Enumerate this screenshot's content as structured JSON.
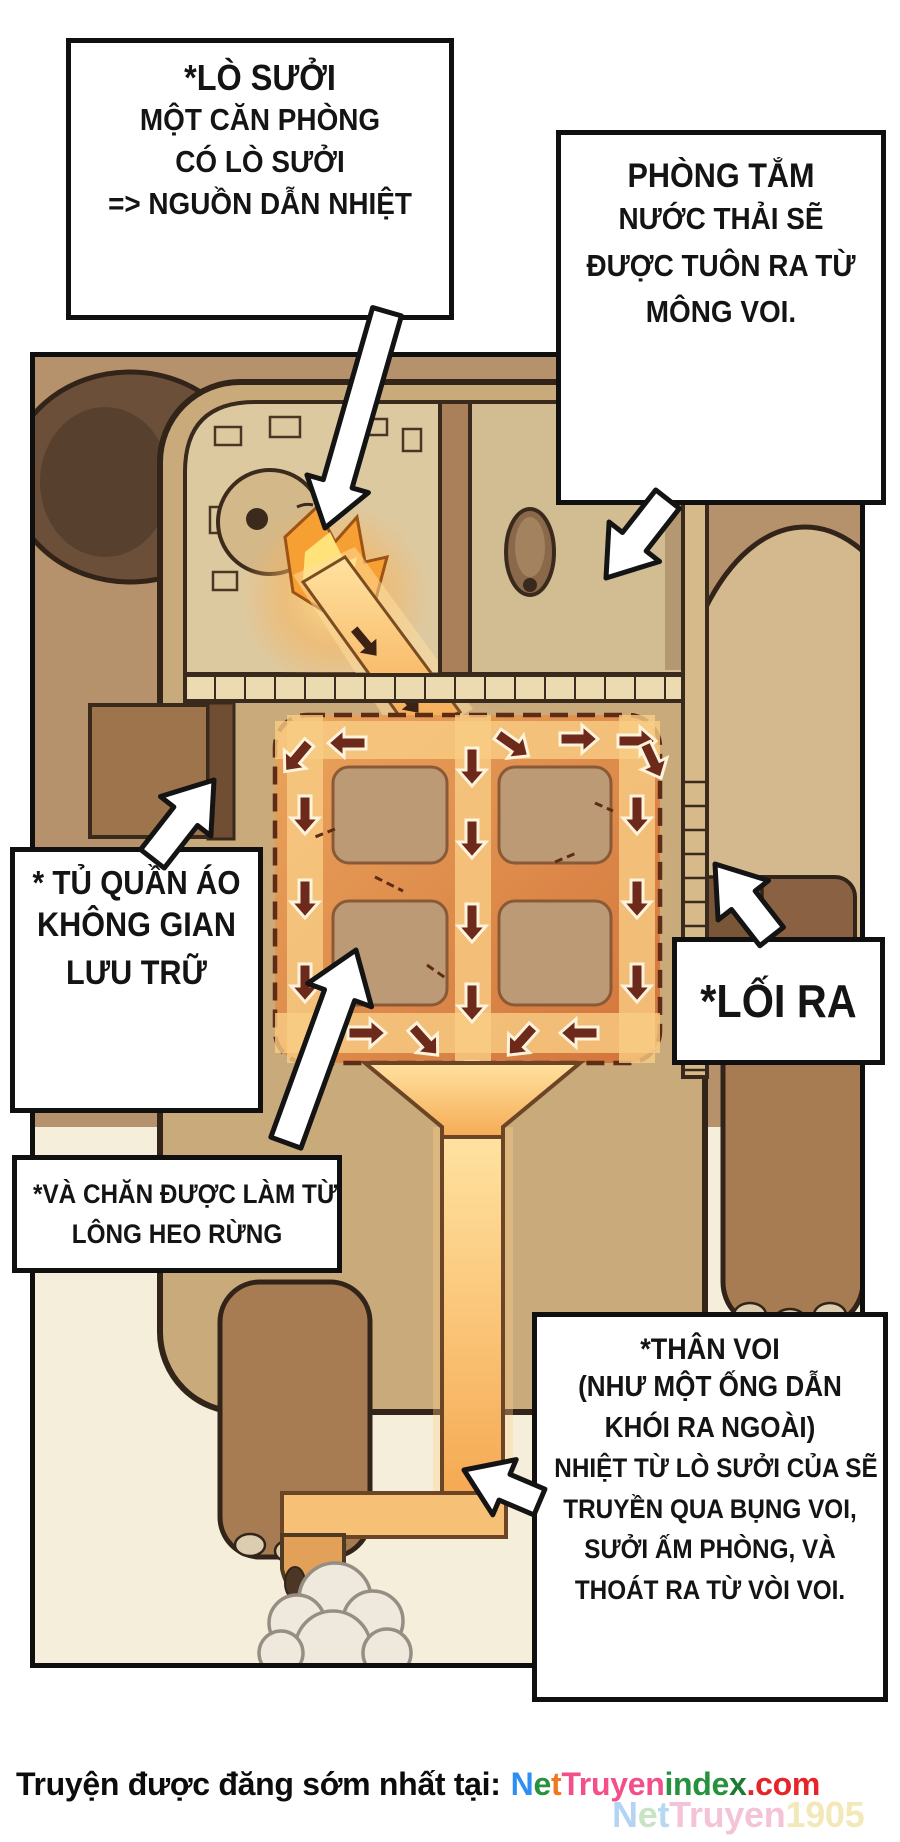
{
  "callouts": {
    "furnace": {
      "title": "*LÒ SƯỞI",
      "lines": [
        "MỘT CĂN PHÒNG",
        "CÓ LÒ SƯỞI",
        "=> NGUỒN DẪN NHIỆT"
      ]
    },
    "bathroom": {
      "title": "PHÒNG TẮM",
      "lines": [
        "NƯỚC THẢI SẼ",
        "ĐƯỢC TUÔN RA TỪ",
        "MÔNG VOI."
      ]
    },
    "wardrobe": {
      "title": "* TỦ QUẦN ÁO",
      "lines": [
        "KHÔNG GIAN",
        "LƯU TRỮ"
      ]
    },
    "blanket": {
      "lines": [
        "*VÀ CHĂN ĐƯỢC LÀM TỪ",
        "LÔNG HEO RỪNG"
      ]
    },
    "exit": {
      "title": "*LỐI RA"
    },
    "trunk": {
      "title": "*THÂN VOI",
      "subtitle_lines": [
        "(NHƯ MỘT ỐNG DẪN",
        "KHÓI RA NGOÀI)"
      ],
      "lines": [
        "NHIỆT TỪ LÒ SƯỞI CỦA SẼ",
        "TRUYỀN QUA BỤNG VOI,",
        "SƯỞI ẤM PHÒNG, VÀ",
        "THOÁT RA TỪ VÒI VOI."
      ]
    }
  },
  "footer": {
    "prefix": "Truyện được đăng sớm nhất tại:",
    "site": "NetTruyenindex.com",
    "site_letters": [
      {
        "ch": "N",
        "color": "#2f8ef2"
      },
      {
        "ch": "e",
        "color": "#27913d"
      },
      {
        "ch": "t",
        "color": "#f0791f"
      },
      {
        "ch": "T",
        "color": "#f24f8b"
      },
      {
        "ch": "r",
        "color": "#f24f8b"
      },
      {
        "ch": "u",
        "color": "#f24f8b"
      },
      {
        "ch": "y",
        "color": "#f24f8b"
      },
      {
        "ch": "e",
        "color": "#f24f8b"
      },
      {
        "ch": "n",
        "color": "#f24f8b"
      },
      {
        "ch": "i",
        "color": "#27913d"
      },
      {
        "ch": "n",
        "color": "#27913d"
      },
      {
        "ch": "d",
        "color": "#27913d"
      },
      {
        "ch": "e",
        "color": "#27913d"
      },
      {
        "ch": "x",
        "color": "#1d7a33"
      },
      {
        "ch": ".",
        "color": "#e52529"
      },
      {
        "ch": "c",
        "color": "#e52529"
      },
      {
        "ch": "o",
        "color": "#e52529"
      },
      {
        "ch": "m",
        "color": "#e52529"
      }
    ],
    "watermark": "NetTruyen1905",
    "watermark_letters": [
      {
        "ch": "N",
        "color": "#a9cdf3"
      },
      {
        "ch": "e",
        "color": "#bfe0bb"
      },
      {
        "ch": "t",
        "color": "#a9d3f0"
      },
      {
        "ch": "T",
        "color": "#f3b9d2"
      },
      {
        "ch": "r",
        "color": "#f3b9d2"
      },
      {
        "ch": "u",
        "color": "#f3b9d2"
      },
      {
        "ch": "y",
        "color": "#f3b9d2"
      },
      {
        "ch": "e",
        "color": "#f3b9d2"
      },
      {
        "ch": "n",
        "color": "#f3b9d2"
      },
      {
        "ch": "1",
        "color": "#f2e4ac"
      },
      {
        "ch": "9",
        "color": "#f2e4ac"
      },
      {
        "ch": "0",
        "color": "#f2e4ac"
      },
      {
        "ch": "5",
        "color": "#f2e4ac"
      }
    ]
  },
  "colors": {
    "panel_wall": "#b6926c",
    "panel_floor": "#f5eedb",
    "heat_channel": "#f6b96a",
    "heat_arrow": "#6d2a1a",
    "fire": "#ffcf4d",
    "callout_border": "#101010"
  }
}
